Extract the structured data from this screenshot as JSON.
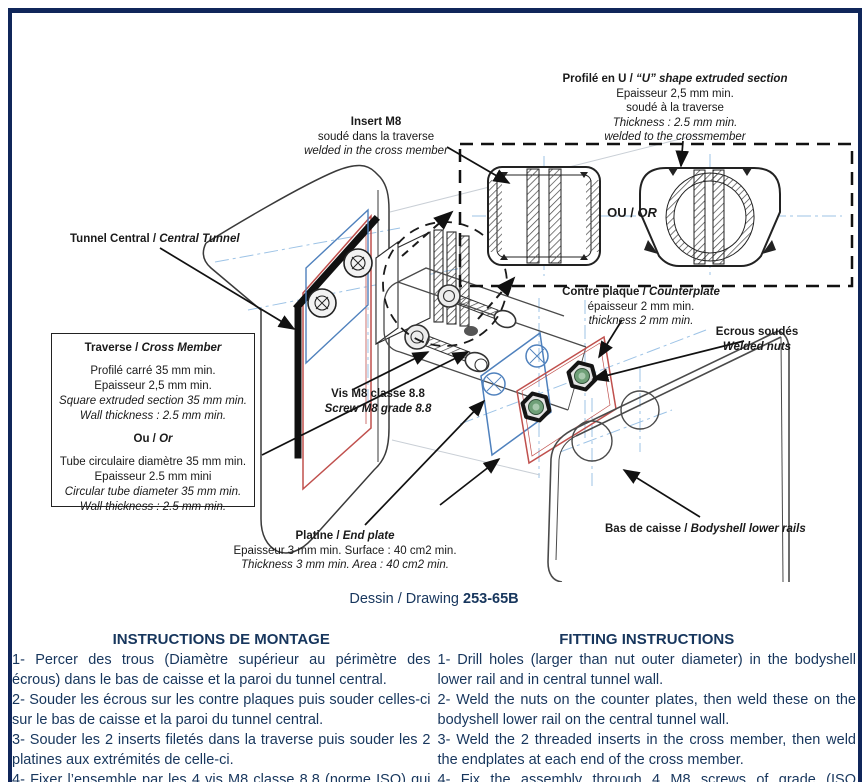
{
  "colors": {
    "border_navy": "#10265a",
    "text_navy": "#17365d",
    "plate_red": "#c0504d",
    "plate_blue": "#4f81bd",
    "nut_green": "#6fa078",
    "centerline_blue": "#9dc3e6"
  },
  "labels": {
    "profil_u": {
      "title_fr": "Profilé en U / ",
      "title_en": "“U” shape extruded section",
      "line1": "Epaisseur 2,5 mm min.",
      "line2": "soudé à la traverse",
      "line3": "Thickness : 2.5 mm min.",
      "line4": "welded to the crossmember"
    },
    "insert_m8": {
      "title": "Insert M8",
      "line1": "soudé dans la traverse",
      "line2": "welded in the cross member"
    },
    "tunnel_central": {
      "fr": "Tunnel Central / ",
      "en": "Central Tunnel"
    },
    "traverse_box": {
      "title_fr": "Traverse / ",
      "title_en": "Cross Member",
      "sq1": "Profilé carré 35 mm min.",
      "sq2": "Epaisseur 2,5 mm min.",
      "sq3": "Square extruded section 35 mm min.",
      "sq4": "Wall thickness : 2.5 mm min.",
      "or_fr": "Ou / ",
      "or_en": "Or",
      "tu1": "Tube circulaire diamètre 35 mm min.",
      "tu2": "Epaisseur 2.5 mm mini",
      "tu3": "Circular tube diameter 35 mm min.",
      "tu4": "Wall thickness : 2.5 mm min."
    },
    "vis_m8": {
      "fr": "Vis M8 classe 8.8",
      "en": "Screw M8 grade 8.8"
    },
    "contre_plaque": {
      "title_fr": "Contre plaque / ",
      "title_en": "Counterplate",
      "line1": "épaisseur 2 mm min.",
      "line2": "thickness 2 mm min."
    },
    "ecrous": {
      "fr": "Ecrous soudés",
      "en": "Welded nuts"
    },
    "platine": {
      "title_fr": "Platine / ",
      "title_en": "End plate",
      "line1": "Epaisseur 3 mm min. Surface : 40 cm2 min.",
      "line2": "Thickness 3 mm min. Area : 40 cm2 min."
    },
    "bas_de_caisse": {
      "fr": "Bas de caisse / ",
      "en": "Bodyshell lower rails"
    },
    "ou_or": {
      "fr": "OU / ",
      "en": "OR"
    }
  },
  "caption": {
    "prefix": "Dessin / Drawing ",
    "number": "253-65B"
  },
  "instructions_fr": {
    "header": "INSTRUCTIONS DE MONTAGE",
    "items": [
      "1- Percer des trous (Diamètre supérieur au périmètre des écrous) dans le bas de caisse et la paroi du tunnel central.",
      "2- Souder les écrous sur les contre plaques puis souder celles-ci sur le bas de caisse et la paroi du tunnel central.",
      "3- Souder les 2 inserts filetés dans la traverse puis souder les 2 platines aux extrémités de celle-ci.",
      "4- Fixer l’ensemble par les 4 vis M8 classe 8.8 (norme ISO) qui se"
    ]
  },
  "instructions_en": {
    "header": "FITTING INSTRUCTIONS",
    "items": [
      "1- Drill holes (larger than nut outer diameter) in the bodyshell lower rail and in central tunnel wall.",
      "2- Weld the nuts on the counter plates, then weld these on the bodyshell lower rail on the central tunnel wall.",
      "3- Weld the 2 threaded inserts in the cross member, then weld the endplates at each end of the cross member.",
      "4- Fix the assembly through 4 M8 screws of grade (ISO standard) 8.8"
    ]
  }
}
